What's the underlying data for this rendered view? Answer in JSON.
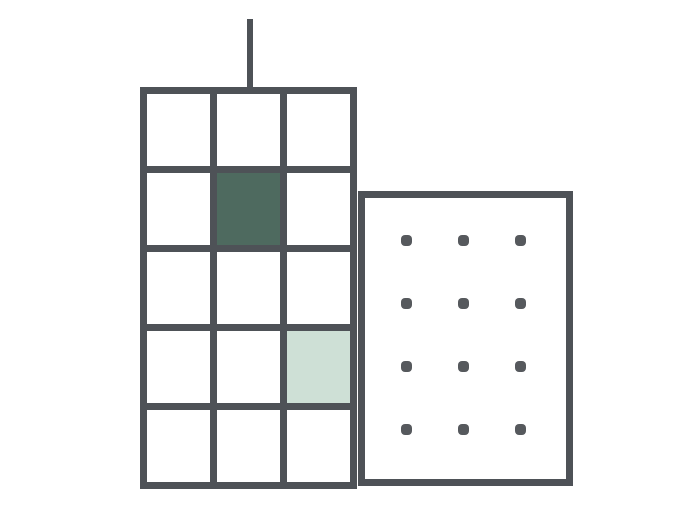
{
  "illustration": {
    "name": "two-buildings-illustration",
    "description_icon": "city-buildings-icon"
  },
  "palette": {
    "background": "#ffffff",
    "outline": "#4e5257",
    "dot": "#56595d",
    "window_dark": "#4e6a5f",
    "window_mint": "#cee0d6"
  },
  "antenna": {
    "present": true
  },
  "tall_building": {
    "grid": {
      "rows": 5,
      "cols": 3
    },
    "filled_windows": [
      {
        "row": 2,
        "col": 2,
        "color_key": "window_dark"
      },
      {
        "row": 4,
        "col": 3,
        "color_key": "window_mint"
      }
    ]
  },
  "short_building": {
    "dot_grid": {
      "rows": 4,
      "cols": 3
    }
  }
}
